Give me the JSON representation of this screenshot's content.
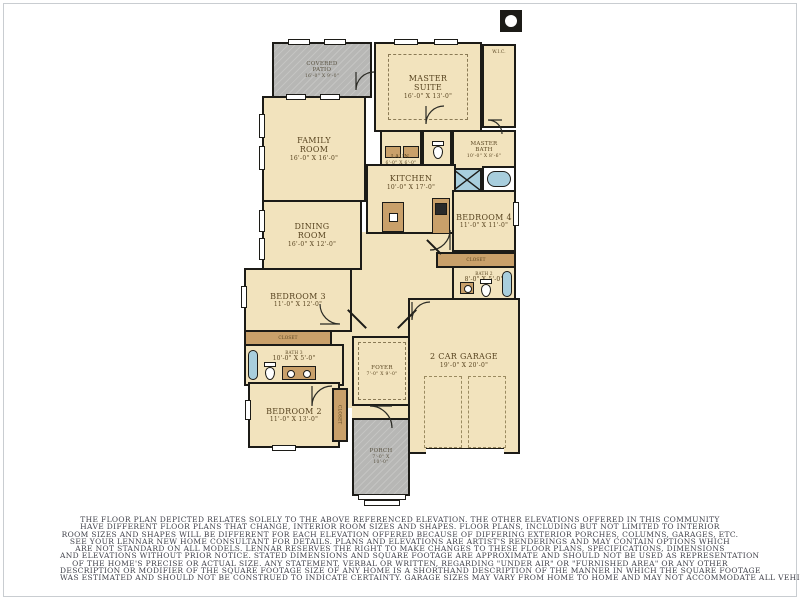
{
  "colors": {
    "wall": "#1c1b17",
    "cream": "#f2e3bd",
    "concrete": "#b7b7b5",
    "tan": "#c9a06a",
    "blue": "#a8cedd",
    "label": "#584420",
    "outdoor-label": "#57503f",
    "disclaimer": "#41424b",
    "frame": "#c9cdd1"
  },
  "plan": {
    "rooms": {
      "covered_patio": {
        "label": "COVERED\nPATIO",
        "dims": "16'-0\" X 9'-0\""
      },
      "master_suite": {
        "label": "MASTER\nSUITE",
        "dims": "16'-0\" X 13'-0\""
      },
      "wic": {
        "label": "W.I.C.",
        "dims": ""
      },
      "family_room": {
        "label": "FAMILY\nROOM",
        "dims": "16'-0\" X 16'-0\""
      },
      "laundry": {
        "label": "LAUN.",
        "dims": "6'-0\" X 6'-0\""
      },
      "master_bath": {
        "label": "MASTER\nBATH",
        "dims": "10'-0\" X 8'-6\""
      },
      "kitchen": {
        "label": "KITCHEN",
        "dims": "10'-0\" X 17'-0\""
      },
      "dining_room": {
        "label": "DINING\nROOM",
        "dims": "16'-0\" X 12'-0\""
      },
      "bedroom_4": {
        "label": "BEDROOM 4",
        "dims": "11'-0\" X 11'-0\""
      },
      "closet_bed4": {
        "label": "CLOSET",
        "dims": ""
      },
      "bath_2": {
        "label": "BATH 2",
        "dims": "8'-0\" X 5'-0\""
      },
      "bedroom_3": {
        "label": "BEDROOM 3",
        "dims": "11'-0\" X 12'-0\""
      },
      "closet_bed3": {
        "label": "CLOSET",
        "dims": ""
      },
      "bath_3": {
        "label": "BATH 3",
        "dims": "10'-0\" X 5'-0\""
      },
      "foyer": {
        "label": "FOYER",
        "dims": "7'-0\" X 9'-0\""
      },
      "garage": {
        "label": "2 CAR GARAGE",
        "dims": "19'-0\" X 20'-0\""
      },
      "bedroom_2": {
        "label": "BEDROOM 2",
        "dims": "11'-0\" X 13'-0\""
      },
      "closet_bed2": {
        "label": "CLOSET",
        "dims": ""
      },
      "porch": {
        "label": "PORCH",
        "dims": "7'-0\" X\n10'-0\""
      }
    }
  },
  "disclaimer": {
    "lines": [
      "THE FLOOR PLAN DEPICTED RELATES SOLELY TO THE ABOVE REFERENCED ELEVATION. THE OTHER ELEVATIONS OFFERED IN THIS COMMUNITY",
      "HAVE DIFFERENT FLOOR PLANS THAT CHANGE, INTERIOR ROOM SIZES AND SHAPES. FLOOR PLANS, INCLUDING BUT NOT LIMITED TO INTERIOR",
      "ROOM SIZES AND SHAPES WILL BE DIFFERENT FOR EACH ELEVATION OFFERED BECAUSE OF DIFFERING EXTERIOR PORCHES, COLUMNS, GARAGES, ETC.",
      "SEE YOUR LENNAR NEW HOME CONSULTANT FOR DETAILS. PLANS AND ELEVATIONS ARE ARTIST'S RENDERINGS AND MAY CONTAIN OPTIONS WHICH",
      "ARE NOT STANDARD ON ALL MODELS. LENNAR RESERVES THE RIGHT TO MAKE CHANGES TO THESE FLOOR PLANS, SPECIFICATIONS, DIMENSIONS",
      "AND ELEVATIONS WITHOUT PRIOR NOTICE. STATED DIMENSIONS AND SQUARE FOOTAGE ARE APPROXIMATE AND SHOULD NOT BE USED AS REPRESENTATION",
      "OF THE HOME'S PRECISE OR ACTUAL SIZE. ANY STATEMENT, VERBAL OR WRITTEN, REGARDING \"UNDER AIR\" OR \"FURNISHED AREA\" OR ANY OTHER",
      "DESCRIPTION OR MODIFIER OF THE SQUARE FOOTAGE SIZE OF ANY HOME IS A SHORTHAND DESCRIPTION OF THE MANNER IN WHICH THE SQUARE FOOTAGE",
      "WAS ESTIMATED AND SHOULD NOT BE CONSTRUED TO INDICATE CERTAINTY. GARAGE SIZES MAY VARY FROM HOME TO HOME AND MAY NOT ACCOMMODATE ALL VEHICLES."
    ]
  }
}
